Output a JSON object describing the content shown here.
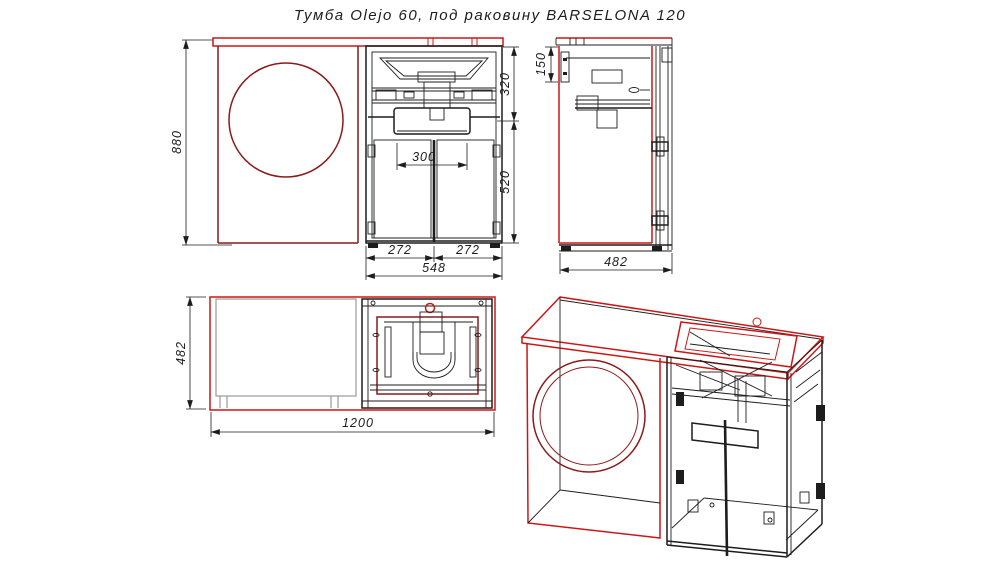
{
  "title": "Тумба Olejo 60, под раковину BARSELONA 120",
  "colors": {
    "outline_red": "#cc1616",
    "dark_red": "#8b1a1a",
    "line_black": "#1d1d1d",
    "washer_gray": "#8f8f8f"
  },
  "views": {
    "front_elevation": "front-elevation",
    "side_view": "side-view",
    "plan_view": "plan-view",
    "perspective_view": "perspective-3d-view"
  },
  "dimensions": {
    "total_height": "880",
    "sink_section_height": "320",
    "door_section_height": "520",
    "apron_height": "150",
    "siphon_clearance_width": "300",
    "left_door_width": "272",
    "right_door_width": "272",
    "cabinet_width": "548",
    "cabinet_depth": "482",
    "plan_depth": "482",
    "total_width": "1200"
  }
}
